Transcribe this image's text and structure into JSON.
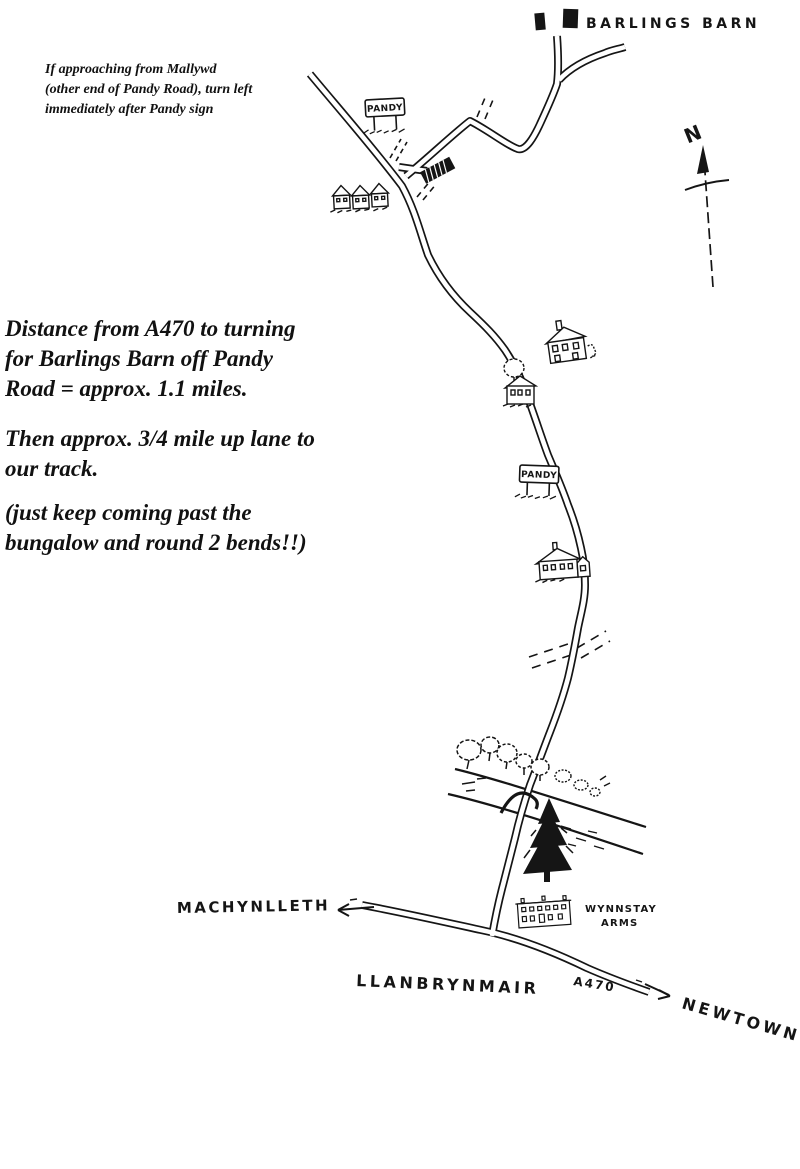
{
  "labels": {
    "barlings_barn": "BARLINGS BARN",
    "pandy_top": "PANDY",
    "pandy_mid": "PANDY",
    "north": "N",
    "machynlleth": "MACHYNLLETH",
    "wynnstay_line1": "WYNNSTAY",
    "wynnstay_line2": "ARMS",
    "llanbrynmair": "LLANBRYNMAIR",
    "a470": "A470",
    "newtown": "NEWTOWN"
  },
  "notes": {
    "approach": "If approaching from Mallywd\n(other end of Pandy Road), turn left\nimmediately after Pandy sign",
    "distance": "Distance from A470 to turning\nfor Barlings Barn off Pandy\nRoad = approx. 1.1 miles.",
    "lane": "Then approx. 3/4 mile up lane to\nour track.",
    "bends": "(just keep coming past the\nbungalow and round 2 bends!!)"
  },
  "colors": {
    "ink": "#151515",
    "paper": "#ffffff"
  }
}
